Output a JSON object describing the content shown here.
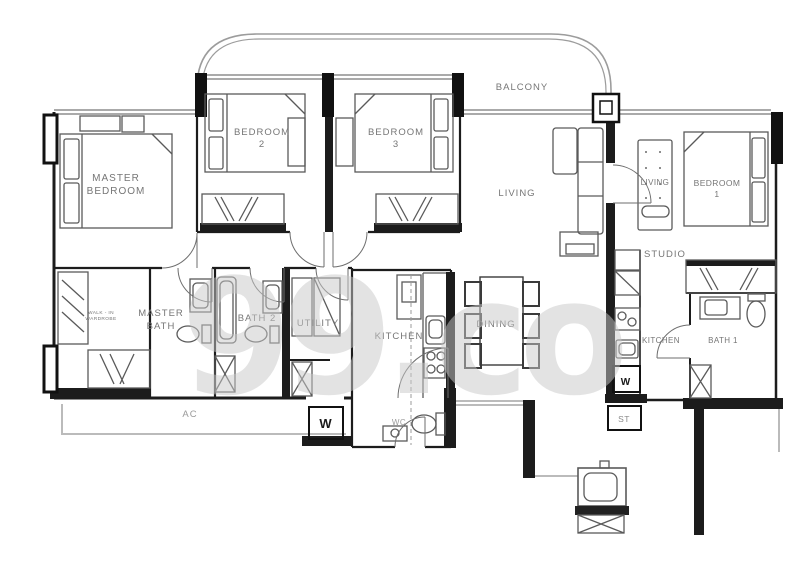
{
  "document": {
    "type": "floor-plan",
    "source_watermark": "99.co"
  },
  "watermark": {
    "text": "99.co",
    "color": "#c9c9c9",
    "opacity": 0.5
  },
  "palette": {
    "walls": "#1c1c1c",
    "interior_walls": "#2a2a2a",
    "furniture": "#5a5a5a",
    "light_gray_lines": "#aaaaaa",
    "label_text": "#767676",
    "muted_text": "#9a9a9a",
    "watermark": "#c9c9c9"
  },
  "plan": {
    "labels": [
      {
        "name": "balcony",
        "lines": [
          "BALCONY"
        ],
        "x": 522,
        "y": 90,
        "size": 9.5
      },
      {
        "name": "master-bedroom",
        "lines": [
          "MASTER",
          "BEDROOM"
        ],
        "x": 116,
        "y": 181,
        "size": 10,
        "lh": 13
      },
      {
        "name": "bedroom-2",
        "lines": [
          "BEDROOM",
          "2"
        ],
        "x": 262,
        "y": 135,
        "size": 9.5,
        "lh": 12
      },
      {
        "name": "bedroom-3",
        "lines": [
          "BEDROOM",
          "3"
        ],
        "x": 396,
        "y": 135,
        "size": 9.5,
        "lh": 12
      },
      {
        "name": "living-main",
        "lines": [
          "LIVING"
        ],
        "x": 517,
        "y": 196,
        "size": 9.5
      },
      {
        "name": "living-studio",
        "lines": [
          "LIVING"
        ],
        "x": 655,
        "y": 185,
        "size": 8
      },
      {
        "name": "bedroom-1",
        "lines": [
          "BEDROOM",
          "1"
        ],
        "x": 717,
        "y": 186,
        "size": 8.5,
        "lh": 11
      },
      {
        "name": "studio",
        "lines": [
          "STUDIO"
        ],
        "x": 665,
        "y": 257,
        "size": 9.5
      },
      {
        "name": "walkin-wardrobe",
        "lines": [
          "WALK - IN",
          "WARDROBE"
        ],
        "x": 101,
        "y": 314,
        "size": 4.8,
        "lh": 6
      },
      {
        "name": "master-bath",
        "lines": [
          "MASTER",
          "BATH"
        ],
        "x": 161,
        "y": 316,
        "size": 9.5,
        "lh": 13
      },
      {
        "name": "bath-2",
        "lines": [
          "BATH 2"
        ],
        "x": 257,
        "y": 321,
        "size": 9.5
      },
      {
        "name": "utility",
        "lines": [
          "UTILITY"
        ],
        "x": 318,
        "y": 326,
        "size": 9.5
      },
      {
        "name": "kitchen-main",
        "lines": [
          "KITCHEN"
        ],
        "x": 399,
        "y": 339,
        "size": 9.5
      },
      {
        "name": "dining",
        "lines": [
          "DINING"
        ],
        "x": 496,
        "y": 327,
        "size": 9.5
      },
      {
        "name": "kitchen-studio",
        "lines": [
          "KITCHEN"
        ],
        "x": 661,
        "y": 343,
        "size": 8
      },
      {
        "name": "bath-1",
        "lines": [
          "BATH 1"
        ],
        "x": 723,
        "y": 343,
        "size": 8
      },
      {
        "name": "ac-ledge",
        "lines": [
          "AC"
        ],
        "x": 190,
        "y": 417,
        "size": 9.5,
        "color": "#9a9a9a"
      },
      {
        "name": "wc",
        "lines": [
          "WC"
        ],
        "x": 399,
        "y": 425,
        "size": 8,
        "color": "#9a9a9a"
      },
      {
        "name": "washer-main",
        "lines": [
          "W"
        ],
        "x": 326,
        "y": 428,
        "size": 13,
        "weight": "bold",
        "color": "#1a1a1a"
      },
      {
        "name": "washer-studio",
        "lines": [
          "W"
        ],
        "x": 626,
        "y": 385,
        "size": 10,
        "weight": "bold",
        "color": "#1a1a1a"
      },
      {
        "name": "storage-st",
        "lines": [
          "ST"
        ],
        "x": 624,
        "y": 422,
        "size": 8.5,
        "color": "#8a8a8a"
      }
    ]
  }
}
